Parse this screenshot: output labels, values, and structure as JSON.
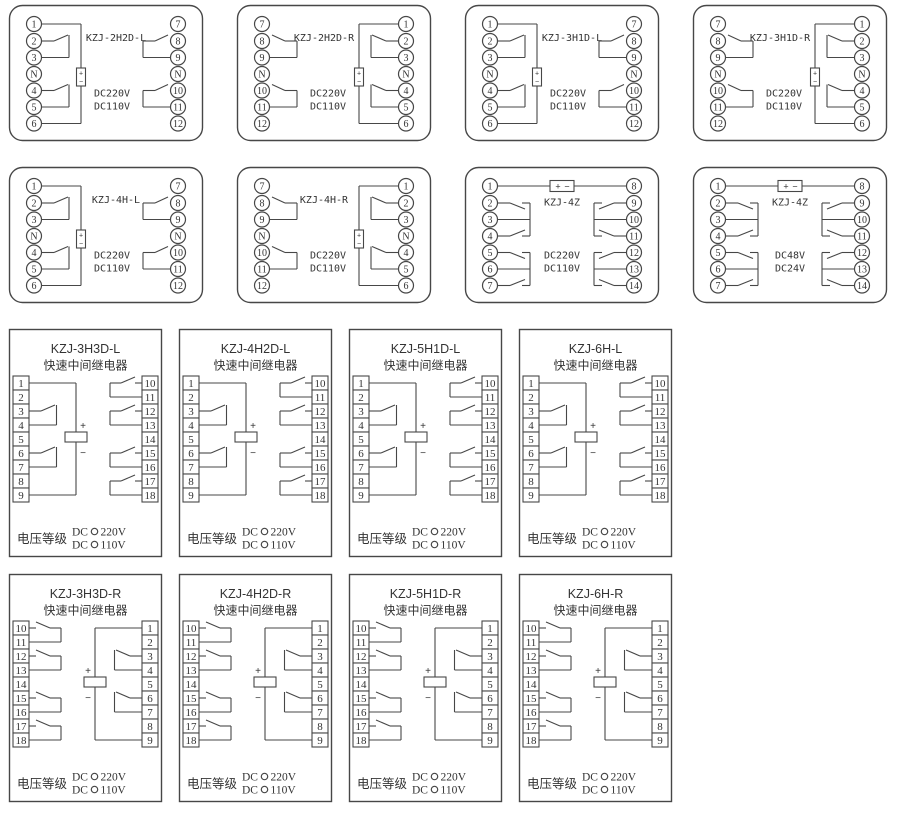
{
  "canvas": {
    "width": 900,
    "height": 814,
    "background": "#ffffff",
    "line_color": "#474747",
    "text_color": "#333333"
  },
  "labels": {
    "coil_plus": "+",
    "coil_minus": "−"
  },
  "strip_labels": {
    "subtitle": "快速中间继电器",
    "voltage_class": "电压等级",
    "dc_prefix": "DC",
    "voltage_options": [
      "220V",
      "110V"
    ]
  },
  "diagrams": [
    {
      "id": "kzj-2h2d-l",
      "type": "socket",
      "mirror": false,
      "title": "KZJ-2H2D-L",
      "voltages": [
        "DC220V",
        "DC110V"
      ],
      "terminals": {
        "left": [
          "1",
          "2",
          "3",
          "N",
          "4",
          "5",
          "6"
        ],
        "right": [
          "7",
          "8",
          "9",
          "N",
          "10",
          "11",
          "12"
        ]
      },
      "contact_pairs": [
        [
          "2",
          "3"
        ],
        [
          "4",
          "5"
        ],
        [
          "8",
          "9"
        ],
        [
          "10",
          "11"
        ]
      ],
      "layout": {
        "row": 0,
        "col": 0
      }
    },
    {
      "id": "kzj-2h2d-r",
      "type": "socket",
      "mirror": true,
      "title": "KZJ-2H2D-R",
      "voltages": [
        "DC220V",
        "DC110V"
      ],
      "terminals": {
        "left": [
          "7",
          "8",
          "9",
          "N",
          "10",
          "11",
          "12"
        ],
        "right": [
          "1",
          "2",
          "3",
          "N",
          "4",
          "5",
          "6"
        ]
      },
      "contact_pairs": [
        [
          "8",
          "9"
        ],
        [
          "10",
          "11"
        ],
        [
          "2",
          "3"
        ],
        [
          "4",
          "5"
        ]
      ],
      "layout": {
        "row": 0,
        "col": 1
      }
    },
    {
      "id": "kzj-3h1d-l",
      "type": "socket",
      "mirror": false,
      "title": "KZJ-3H1D-L",
      "voltages": [
        "DC220V",
        "DC110V"
      ],
      "terminals": {
        "left": [
          "1",
          "2",
          "3",
          "N",
          "4",
          "5",
          "6"
        ],
        "right": [
          "7",
          "8",
          "9",
          "N",
          "10",
          "11",
          "12"
        ]
      },
      "contact_pairs": [
        [
          "2",
          "3"
        ],
        [
          "4",
          "5"
        ],
        [
          "8",
          "9"
        ],
        [
          "10",
          "11"
        ]
      ],
      "layout": {
        "row": 0,
        "col": 2
      }
    },
    {
      "id": "kzj-3h1d-r",
      "type": "socket",
      "mirror": true,
      "title": "KZJ-3H1D-R",
      "voltages": [
        "DC220V",
        "DC110V"
      ],
      "terminals": {
        "left": [
          "7",
          "8",
          "9",
          "N",
          "10",
          "11",
          "12"
        ],
        "right": [
          "1",
          "2",
          "3",
          "N",
          "4",
          "5",
          "6"
        ]
      },
      "contact_pairs": [
        [
          "8",
          "9"
        ],
        [
          "10",
          "11"
        ],
        [
          "2",
          "3"
        ],
        [
          "4",
          "5"
        ]
      ],
      "layout": {
        "row": 0,
        "col": 3
      }
    },
    {
      "id": "kzj-4h-l",
      "type": "socket",
      "mirror": false,
      "title": "KZJ-4H-L",
      "voltages": [
        "DC220V",
        "DC110V"
      ],
      "terminals": {
        "left": [
          "1",
          "2",
          "3",
          "N",
          "4",
          "5",
          "6"
        ],
        "right": [
          "7",
          "8",
          "9",
          "N",
          "10",
          "11",
          "12"
        ]
      },
      "contact_pairs": [
        [
          "2",
          "3"
        ],
        [
          "4",
          "5"
        ],
        [
          "8",
          "9"
        ],
        [
          "10",
          "11"
        ]
      ],
      "layout": {
        "row": 1,
        "col": 0
      }
    },
    {
      "id": "kzj-4h-r",
      "type": "socket",
      "mirror": true,
      "title": "KZJ-4H-R",
      "voltages": [
        "DC220V",
        "DC110V"
      ],
      "terminals": {
        "left": [
          "7",
          "8",
          "9",
          "N",
          "10",
          "11",
          "12"
        ],
        "right": [
          "1",
          "2",
          "3",
          "N",
          "4",
          "5",
          "6"
        ]
      },
      "contact_pairs": [
        [
          "8",
          "9"
        ],
        [
          "10",
          "11"
        ],
        [
          "2",
          "3"
        ],
        [
          "4",
          "5"
        ]
      ],
      "layout": {
        "row": 1,
        "col": 1
      }
    },
    {
      "id": "kzj-4z-220",
      "type": "socket-z",
      "mirror": false,
      "title": "KZJ-4Z",
      "voltages": [
        "DC220V",
        "DC110V"
      ],
      "terminals": {
        "left": [
          "1",
          "2",
          "3",
          "4",
          "5",
          "6",
          "7"
        ],
        "right": [
          "8",
          "9",
          "10",
          "11",
          "12",
          "13",
          "14"
        ]
      },
      "contact_pairs": [
        [
          "2",
          "3",
          "4"
        ],
        [
          "5",
          "6",
          "7"
        ],
        [
          "9",
          "10",
          "11"
        ],
        [
          "12",
          "13",
          "14"
        ]
      ],
      "layout": {
        "row": 1,
        "col": 2
      }
    },
    {
      "id": "kzj-4z-48",
      "type": "socket-z",
      "mirror": false,
      "title": "KZJ-4Z",
      "voltages": [
        "DC48V",
        "DC24V"
      ],
      "terminals": {
        "left": [
          "1",
          "2",
          "3",
          "4",
          "5",
          "6",
          "7"
        ],
        "right": [
          "8",
          "9",
          "10",
          "11",
          "12",
          "13",
          "14"
        ]
      },
      "contact_pairs": [
        [
          "2",
          "3",
          "4"
        ],
        [
          "5",
          "6",
          "7"
        ],
        [
          "9",
          "10",
          "11"
        ],
        [
          "12",
          "13",
          "14"
        ]
      ],
      "layout": {
        "row": 1,
        "col": 3
      }
    },
    {
      "id": "kzj-3h3d-l",
      "type": "strip",
      "mirror": false,
      "title": "KZJ-3H3D-L",
      "terminals": {
        "left": [
          "1",
          "2",
          "3",
          "4",
          "5",
          "6",
          "7",
          "8",
          "9"
        ],
        "right": [
          "10",
          "11",
          "12",
          "13",
          "14",
          "15",
          "16",
          "17",
          "18"
        ]
      },
      "contact_pairs": [
        [
          "3",
          "4"
        ],
        [
          "6",
          "7"
        ],
        [
          "10",
          "11"
        ],
        [
          "12",
          "13"
        ],
        [
          "15",
          "16"
        ],
        [
          "17",
          "18"
        ]
      ],
      "layout": {
        "row": 2,
        "col": 0
      }
    },
    {
      "id": "kzj-4h2d-l",
      "type": "strip",
      "mirror": false,
      "title": "KZJ-4H2D-L",
      "terminals": {
        "left": [
          "1",
          "2",
          "3",
          "4",
          "5",
          "6",
          "7",
          "8",
          "9"
        ],
        "right": [
          "10",
          "11",
          "12",
          "13",
          "14",
          "15",
          "16",
          "17",
          "18"
        ]
      },
      "contact_pairs": [
        [
          "3",
          "4"
        ],
        [
          "6",
          "7"
        ],
        [
          "10",
          "11"
        ],
        [
          "12",
          "13"
        ],
        [
          "15",
          "16"
        ],
        [
          "17",
          "18"
        ]
      ],
      "layout": {
        "row": 2,
        "col": 1
      }
    },
    {
      "id": "kzj-5h1d-l",
      "type": "strip",
      "mirror": false,
      "title": "KZJ-5H1D-L",
      "terminals": {
        "left": [
          "1",
          "2",
          "3",
          "4",
          "5",
          "6",
          "7",
          "8",
          "9"
        ],
        "right": [
          "10",
          "11",
          "12",
          "13",
          "14",
          "15",
          "16",
          "17",
          "18"
        ]
      },
      "contact_pairs": [
        [
          "3",
          "4"
        ],
        [
          "6",
          "7"
        ],
        [
          "10",
          "11"
        ],
        [
          "12",
          "13"
        ],
        [
          "15",
          "16"
        ],
        [
          "17",
          "18"
        ]
      ],
      "layout": {
        "row": 2,
        "col": 2
      }
    },
    {
      "id": "kzj-6h-l",
      "type": "strip",
      "mirror": false,
      "title": "KZJ-6H-L",
      "terminals": {
        "left": [
          "1",
          "2",
          "3",
          "4",
          "5",
          "6",
          "7",
          "8",
          "9"
        ],
        "right": [
          "10",
          "11",
          "12",
          "13",
          "14",
          "15",
          "16",
          "17",
          "18"
        ]
      },
      "contact_pairs": [
        [
          "3",
          "4"
        ],
        [
          "6",
          "7"
        ],
        [
          "10",
          "11"
        ],
        [
          "12",
          "13"
        ],
        [
          "15",
          "16"
        ],
        [
          "17",
          "18"
        ]
      ],
      "layout": {
        "row": 2,
        "col": 3
      }
    },
    {
      "id": "kzj-3h3d-r",
      "type": "strip",
      "mirror": true,
      "title": "KZJ-3H3D-R",
      "terminals": {
        "left": [
          "10",
          "11",
          "12",
          "13",
          "14",
          "15",
          "16",
          "17",
          "18"
        ],
        "right": [
          "1",
          "2",
          "3",
          "4",
          "5",
          "6",
          "7",
          "8",
          "9"
        ]
      },
      "contact_pairs": [
        [
          "10",
          "11"
        ],
        [
          "12",
          "13"
        ],
        [
          "15",
          "16"
        ],
        [
          "17",
          "18"
        ],
        [
          "3",
          "4"
        ],
        [
          "6",
          "7"
        ]
      ],
      "layout": {
        "row": 3,
        "col": 0
      }
    },
    {
      "id": "kzj-4h2d-r",
      "type": "strip",
      "mirror": true,
      "title": "KZJ-4H2D-R",
      "terminals": {
        "left": [
          "10",
          "11",
          "12",
          "13",
          "14",
          "15",
          "16",
          "17",
          "18"
        ],
        "right": [
          "1",
          "2",
          "3",
          "4",
          "5",
          "6",
          "7",
          "8",
          "9"
        ]
      },
      "contact_pairs": [
        [
          "10",
          "11"
        ],
        [
          "12",
          "13"
        ],
        [
          "15",
          "16"
        ],
        [
          "17",
          "18"
        ],
        [
          "3",
          "4"
        ],
        [
          "6",
          "7"
        ]
      ],
      "layout": {
        "row": 3,
        "col": 1
      }
    },
    {
      "id": "kzj-5h1d-r",
      "type": "strip",
      "mirror": true,
      "title": "KZJ-5H1D-R",
      "terminals": {
        "left": [
          "10",
          "11",
          "12",
          "13",
          "14",
          "15",
          "16",
          "17",
          "18"
        ],
        "right": [
          "1",
          "2",
          "3",
          "4",
          "5",
          "6",
          "7",
          "8",
          "9"
        ]
      },
      "contact_pairs": [
        [
          "10",
          "11"
        ],
        [
          "12",
          "13"
        ],
        [
          "15",
          "16"
        ],
        [
          "17",
          "18"
        ],
        [
          "3",
          "4"
        ],
        [
          "6",
          "7"
        ]
      ],
      "layout": {
        "row": 3,
        "col": 2
      }
    },
    {
      "id": "kzj-6h-r",
      "type": "strip",
      "mirror": true,
      "title": "KZJ-6H-R",
      "terminals": {
        "left": [
          "10",
          "11",
          "12",
          "13",
          "14",
          "15",
          "16",
          "17",
          "18"
        ],
        "right": [
          "1",
          "2",
          "3",
          "4",
          "5",
          "6",
          "7",
          "8",
          "9"
        ]
      },
      "contact_pairs": [
        [
          "10",
          "11"
        ],
        [
          "12",
          "13"
        ],
        [
          "15",
          "16"
        ],
        [
          "17",
          "18"
        ],
        [
          "3",
          "4"
        ],
        [
          "6",
          "7"
        ]
      ],
      "layout": {
        "row": 3,
        "col": 3
      }
    }
  ]
}
